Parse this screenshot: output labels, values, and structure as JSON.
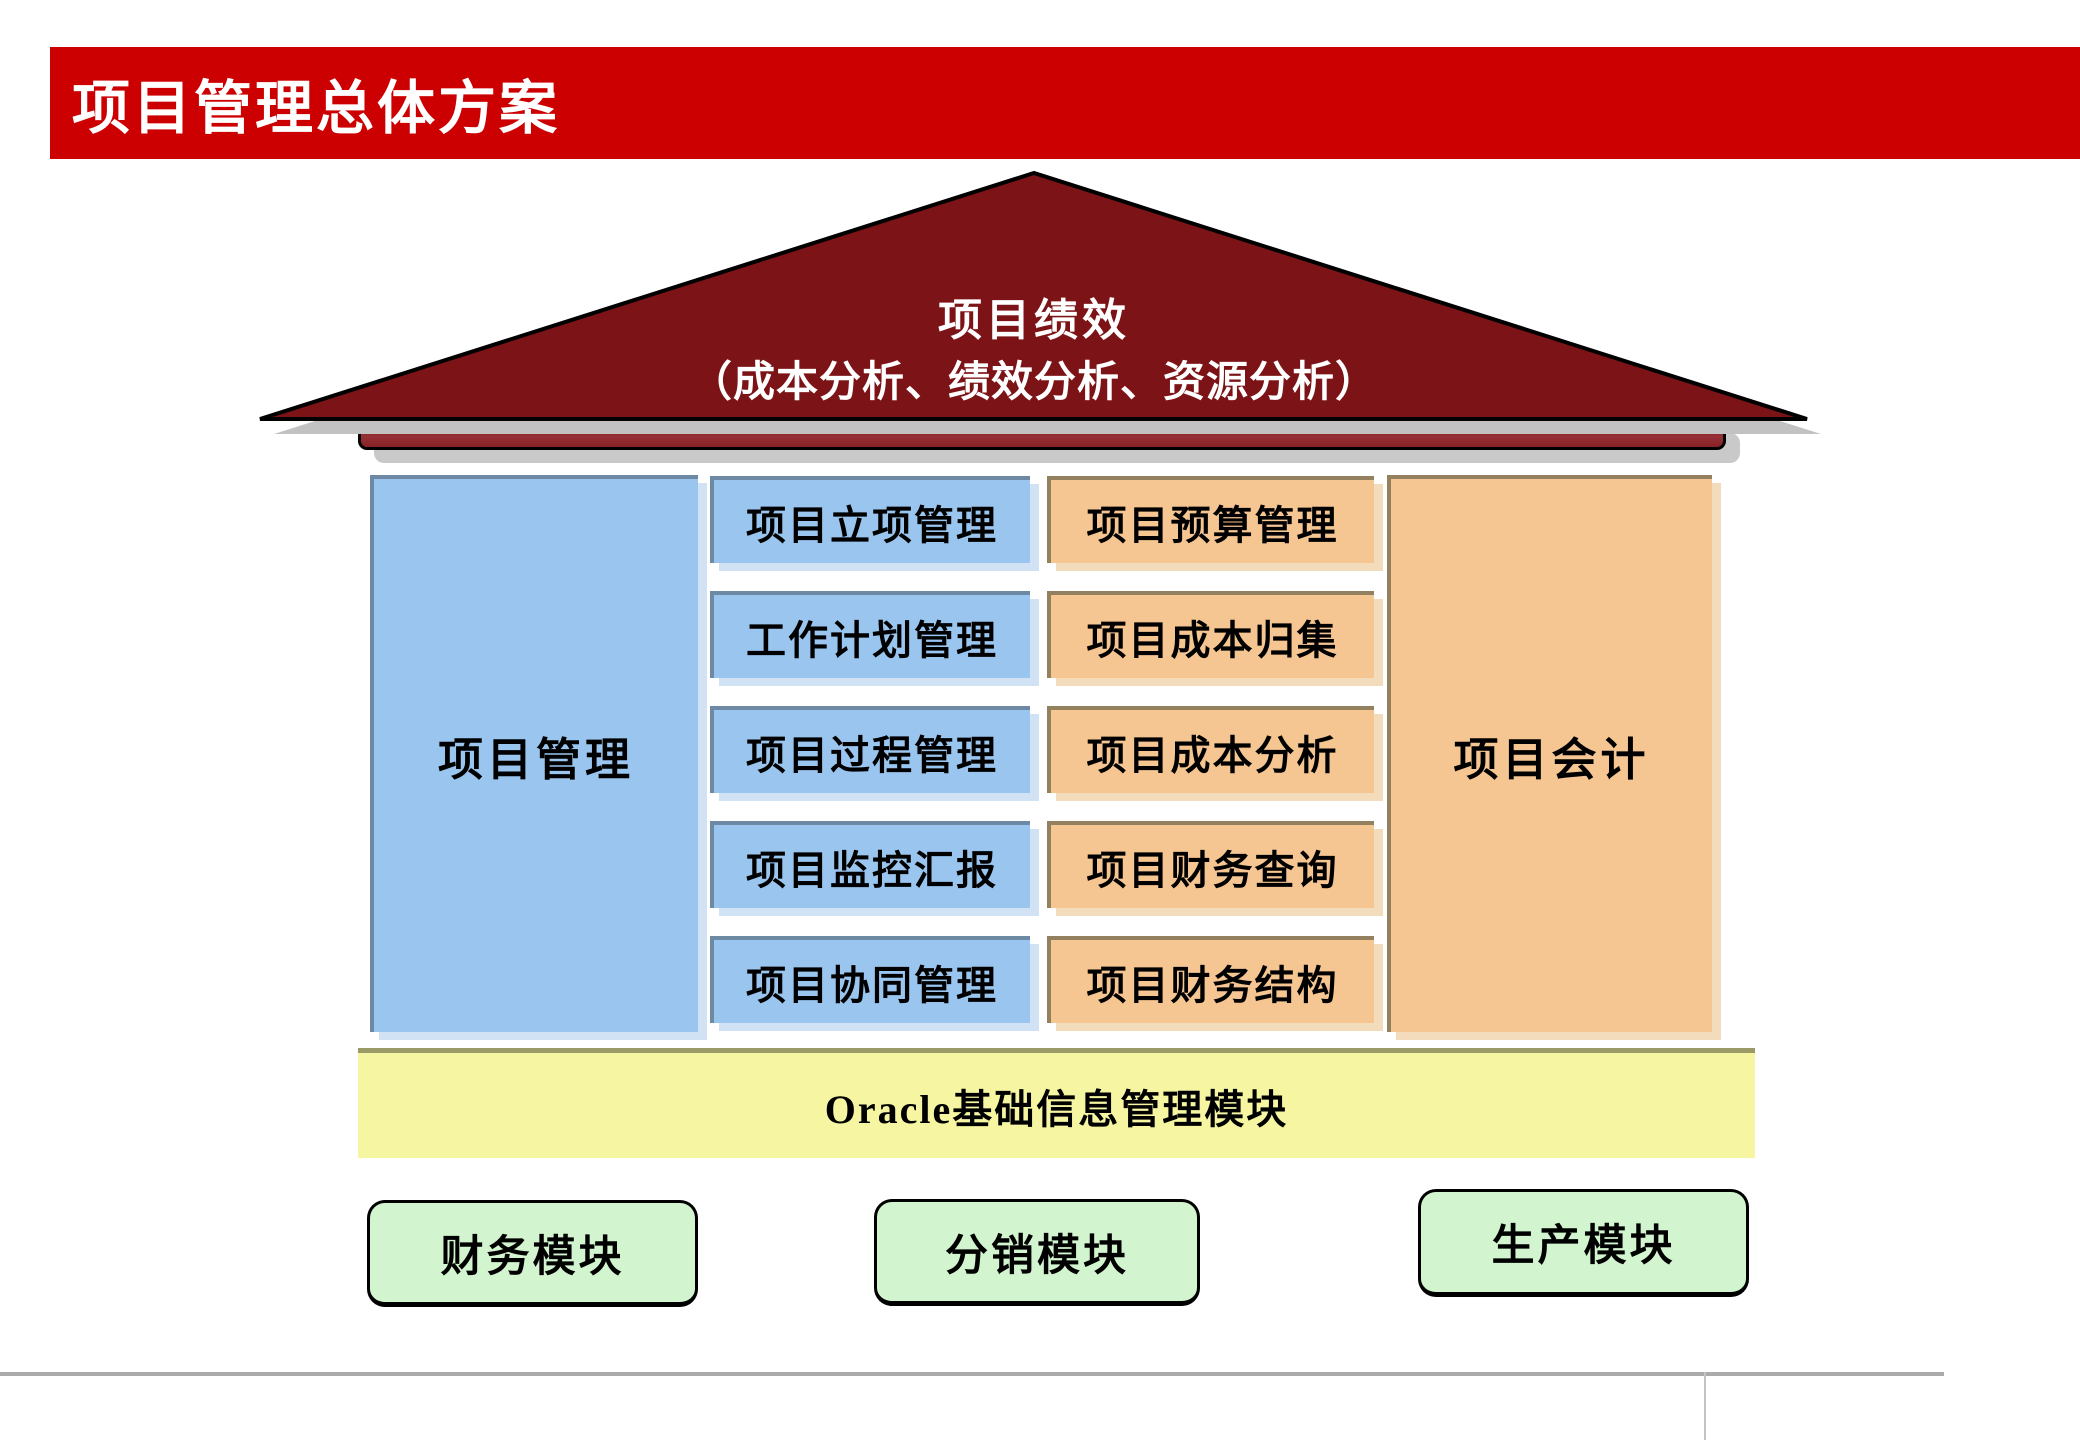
{
  "header": {
    "title": "项目管理总体方案",
    "bar_color": "#CC0000",
    "text_color": "#FFFFFF"
  },
  "roof": {
    "line1": "项目绩效",
    "line2": "（成本分析、绩效分析、资源分析）",
    "fill": "#7C1316",
    "outline": "#000000",
    "shadow_color": "#C2C2C2",
    "beam_color": "#8E2326",
    "beam_shadow_color": "#C9C9C9",
    "text_color": "#FFFFFF"
  },
  "pillars": {
    "left": {
      "label": "项目管理",
      "fill": "#99C5EF"
    },
    "right": {
      "label": "项目会计",
      "fill": "#F5C592"
    }
  },
  "modules": {
    "project_management": [
      "项目立项管理",
      "工作计划管理",
      "项目过程管理",
      "项目监控汇报",
      "项目协同管理"
    ],
    "project_accounting": [
      "项目预算管理",
      "项目成本归集",
      "项目成本分析",
      "项目财务查询",
      "项目财务结构"
    ]
  },
  "platform": {
    "label": "Oracle基础信息管理模块",
    "fill": "#F5F5A2",
    "border_color": "#9A9A66"
  },
  "base_modules": [
    "财务模块",
    "分销模块",
    "生产模块"
  ],
  "base_fill": "#D2F4CF"
}
